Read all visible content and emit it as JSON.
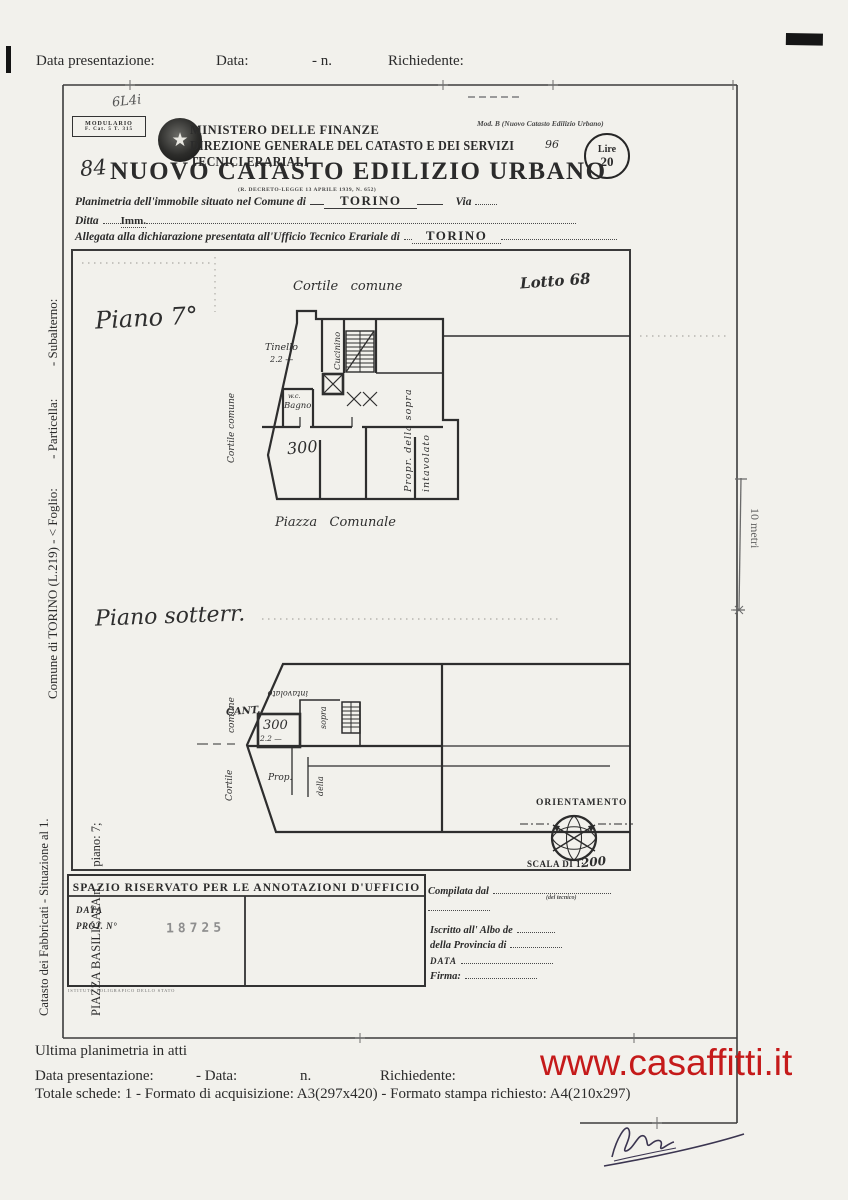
{
  "top_row": {
    "presentazione": "Data presentazione:",
    "data": "Data:",
    "n": "- n.",
    "richiedente": "Richiedente:"
  },
  "header": {
    "modulario_line1": "MODULARIO",
    "modulario_line2": "F. Cat. 5 T. 315",
    "handwritten_note": "6L4i",
    "mod_b": "Mod. B (Nuovo Catasto Edilizio Urbano)",
    "ministero": "MINISTERO DELLE FINANZE",
    "direzione": "DIREZIONE GENERALE DEL CATASTO E DEI SERVIZI TECNICI ERARIALI",
    "direzione_note": "96",
    "lire_label": "Lire",
    "lire_value": "20",
    "numero_hand": "84",
    "title": "NUOVO CATASTO EDILIZIO URBANO",
    "subtitle": "(R. DECRETO-LEGGE 13 APRILE 1939, N. 652)",
    "field1_label": "Planimetria dell'immobile situato nel Comune di",
    "field1_value": "TORINO",
    "field1_suffix": "Via",
    "field2_label": "Ditta",
    "field2_value": "Imm.",
    "field3_label": "Allegata alla dichiarazione presentata all'Ufficio Tecnico Erariale di",
    "field3_value": "TORINO"
  },
  "plan": {
    "lotto": "Lotto 68",
    "floor_label": "Piano 7°",
    "cortile_top": "Cortile   comune",
    "cortile_left": "Cortile comune",
    "tinello": "Tinello",
    "tinello_dim": "2.2 —",
    "cucinino": "Cucinino",
    "wc": "w.c.",
    "bagno": "Bagno",
    "area": "300",
    "propr": "Propr. della sopra intavolato",
    "piazza": "Piazza   Comunale"
  },
  "basement": {
    "floor_label": "Piano sotterr.",
    "cortile": "Cortile",
    "comune": "comune",
    "cant": "CANT.",
    "area": "300",
    "dim": "2.2 —",
    "prop": "Prop.",
    "della": "della",
    "sopra": "sopra",
    "intavolato": "intavolato"
  },
  "compass": {
    "orientamento": "ORIENTAMENTO",
    "scala": "SCALA DI 1:",
    "scala_hand": "200"
  },
  "scale_bar": {
    "label": "10 metri"
  },
  "sidebar": {
    "line1": "Comune di TORINO (L.219) - < Foglio:         - Particella:          - Subalterno:",
    "line2a": "Catasto dei Fabbricati - Situazione al 1.",
    "line2b": "PIAZZA BASILICATA n.      piano: 7;"
  },
  "annotations": {
    "header": "SPAZIO RISERVATO PER LE ANNOTAZIONI D'UFFICIO",
    "data_label": "DATA",
    "prot_label": "PROT. N°",
    "prot_value": "18725",
    "tiny_print": "ISTITUTO POLIGRAFICO DELLO STATO",
    "compilata": "Compilata dal",
    "del_tecnico": "(del tecnico)",
    "iscritto": "Iscritto all' Albo de",
    "provincia": "della Provincia di",
    "data_label2": "DATA",
    "firma": "Firma:"
  },
  "footer": {
    "ultima": "Ultima planimetria in atti",
    "presentazione": "Data presentazione:",
    "data": "- Data:",
    "n": "n.",
    "richiedente": "Richiedente:",
    "totale": "Totale schede: 1 - Formato di acquisizione: A3(297x420) - Formato stampa richiesto: A4(210x297)",
    "watermark": "www.casaffitti.it"
  }
}
